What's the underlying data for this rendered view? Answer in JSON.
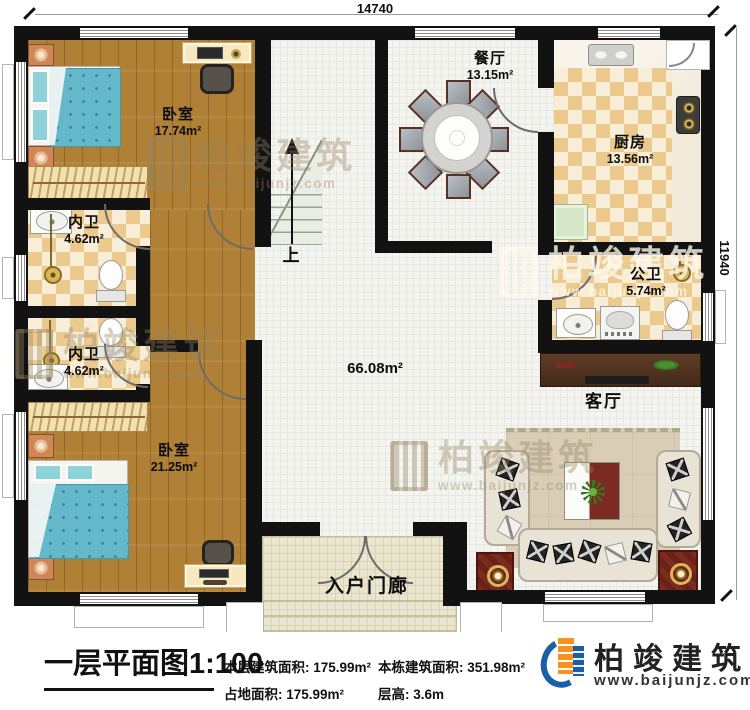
{
  "dimensions": {
    "width_mm": "14740",
    "height_mm": "11940"
  },
  "stair": {
    "up_label": "上"
  },
  "rooms": {
    "bedroom_top": {
      "name": "卧室",
      "area": "17.74m²"
    },
    "bedroom_bottom": {
      "name": "卧室",
      "area": "21.25m²"
    },
    "ensuite_top": {
      "name": "内卫",
      "area": "4.62m²"
    },
    "ensuite_bottom": {
      "name": "内卫",
      "area": "4.62m²"
    },
    "public_bath": {
      "name": "公卫",
      "area": "5.74m²"
    },
    "kitchen": {
      "name": "厨房",
      "area": "13.56m²"
    },
    "dining": {
      "name": "餐厅",
      "area": "13.15m²"
    },
    "living": {
      "name": "客厅"
    },
    "hall": {
      "area": "66.08m²"
    },
    "porch": {
      "name": "入户门廊"
    }
  },
  "footer": {
    "title": "一层平面图",
    "scale": "1:100",
    "stats": {
      "floor_area_label": "本层建筑面积:",
      "floor_area_value": "175.99m²",
      "land_area_label": "占地面积:",
      "land_area_value": "175.99m²",
      "total_area_label": "本栋建筑面积:",
      "total_area_value": "351.98m²",
      "story_height_label": "层高:",
      "story_height_value": "3.6m"
    }
  },
  "brand": {
    "name": "柏竣建筑",
    "url": "www.baijunjz.com"
  },
  "watermark": {
    "name": "柏竣建筑",
    "url": "www.baijunjz.com"
  },
  "colors": {
    "wall": "#121212",
    "wood": "#b08036",
    "tile_dark": "#ecca8d",
    "tile_light": "#f8eed7",
    "brand_blue": "#1a5fa8",
    "brand_orange": "#f6921e",
    "bed_blue": "#64b8ca",
    "accent_red": "#7c2b20"
  }
}
